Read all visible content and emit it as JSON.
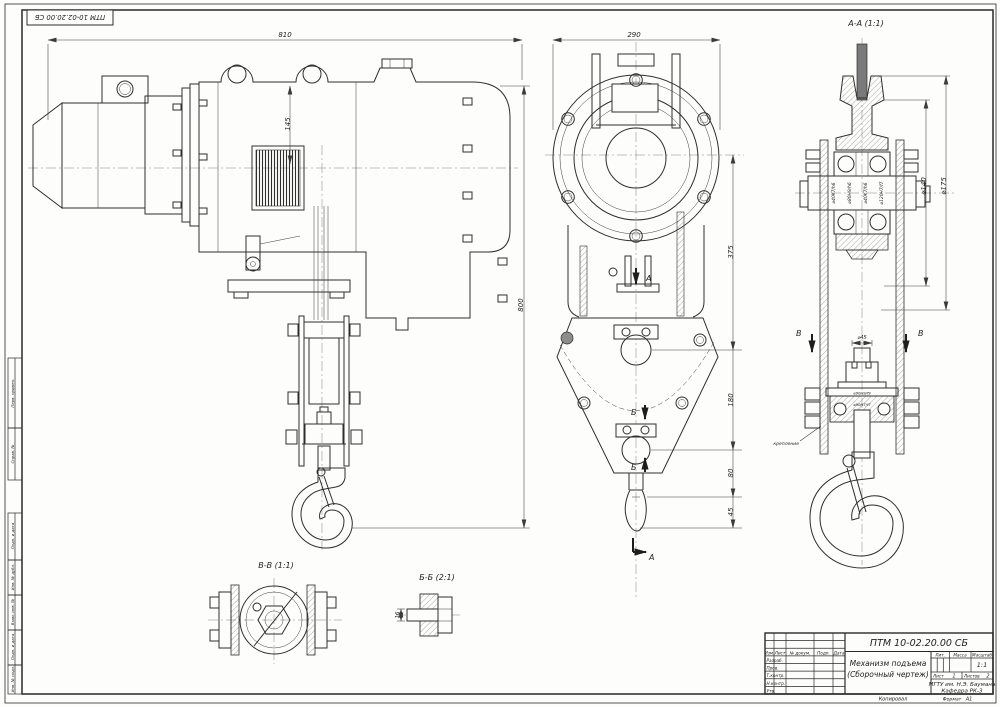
{
  "sheet": {
    "corner_stamp": "ПТМ 10-02.20.00 СБ",
    "copied_label": "Копировал",
    "format_label": "Формат",
    "format_value": "А1"
  },
  "margin_stamps": [
    "Перв. примен.",
    "Справ. №",
    "Подп. и дата",
    "Инв. № дубл.",
    "Взам. инв. №",
    "Подп. и дата",
    "Инв. № подл."
  ],
  "titleblock": {
    "designation": "ПТМ 10-02.20.00 СБ",
    "name_line1": "Механизм подъема",
    "name_line2": "(Сборочный чертеж)",
    "org_line1": "МГТУ им. Н.Э. Баумана",
    "org_line2": "Кафедра РК-3",
    "col_izm": "Изм.",
    "col_list": "Лист",
    "col_doc": "№ докум.",
    "col_sign": "Подп.",
    "col_date": "Дата",
    "row_razrab": "Разраб.",
    "row_prov": "Пров.",
    "row_tkontr": "Т.контр.",
    "row_nkontr": "Н.контр.",
    "row_utv": "Утв.",
    "lit_label": "Лит.",
    "mass_label": "Масса",
    "scale_label": "Масштаб",
    "scale_value": "1:1",
    "sheet_label": "Лист",
    "sheet_value": "1",
    "sheets_label": "Листов",
    "sheets_value": "2"
  },
  "views": {
    "side": {
      "dim_width": "810",
      "dim_height": "800",
      "dim_drum": "145"
    },
    "front": {
      "dim_width": "290",
      "dim_1": "375",
      "dim_2": "180",
      "dim_3": "80",
      "dim_4": "45",
      "sec_a": "А",
      "sec_b": "Б"
    },
    "aa": {
      "title": "А-А (1:1)",
      "sec_v": "В",
      "fits": [
        "⌀40K7/h6",
        "⌀80H9/h6",
        "⌀40K7/h6",
        "⌀120H7/f7"
      ],
      "fit_tr1": "⌀90H9/f9",
      "fit_tr2": "⌀90H7/f7",
      "dia_1": "⌀140",
      "dia_2": "⌀175",
      "dia_stem": "⌀45",
      "note": "крепление"
    },
    "vv": {
      "title": "В-В (1:1)"
    },
    "bb": {
      "title": "Б-Б (2:1)",
      "dim": "16"
    }
  }
}
